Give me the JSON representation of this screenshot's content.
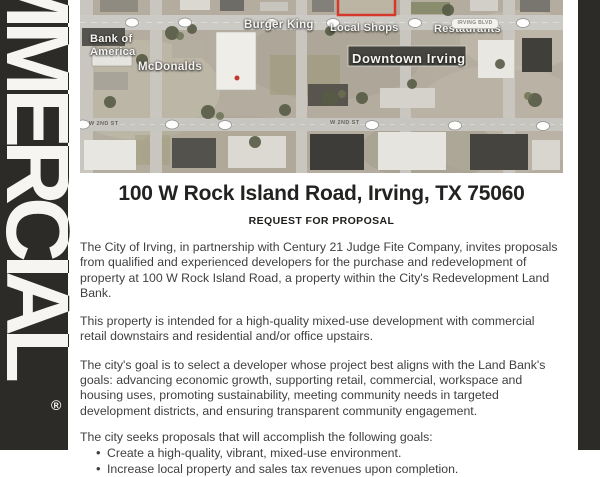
{
  "colors": {
    "sidebar_bg": "#2c2b28",
    "accent_red": "#d4392c",
    "map_label": "#f5f4f0"
  },
  "sidebar": {
    "word": "COMMERCIAL",
    "registered": "®"
  },
  "map": {
    "poi": {
      "bank": "Bank of\nAmerica",
      "mcdonalds": "McDonalds",
      "burger_king": "Burger King",
      "local_shops": "Local Shops",
      "restaurants": "Restaurants",
      "downtown": "Downtown Irving"
    },
    "streets": {
      "irving_blvd": "IRVING BLVD",
      "second_st_left": "W 2ND ST",
      "second_st_right": "W 2ND ST"
    }
  },
  "heading": {
    "title": "100 W Rock Island Road, Irving, TX 75060",
    "subtitle": "REQUEST FOR PROPOSAL"
  },
  "body": {
    "paragraphs": [
      "The City of Irving, in partnership with Century 21 Judge Fite Company, invites proposals from qualified and experienced developers for the purchase and redevelopment of property at 100 W Rock Island Road, a property within the City's Redevelopment Land Bank.",
      "This property is intended for a high-quality mixed-use development with commercial retail downstairs and residential and/or office upstairs.",
      "The city's goal is to select a developer whose project best aligns with the Land Bank's goals: advancing economic growth, supporting retail, commercial, workspace and housing uses, promoting sustainability, meeting community needs in targeted development districts, and ensuring transparent community engagement."
    ],
    "goals_intro": "The city seeks proposals that will accomplish the following goals:",
    "goals": [
      "Create a high-quality, vibrant, mixed-use environment.",
      "Increase local property and sales tax revenues upon completion."
    ]
  }
}
